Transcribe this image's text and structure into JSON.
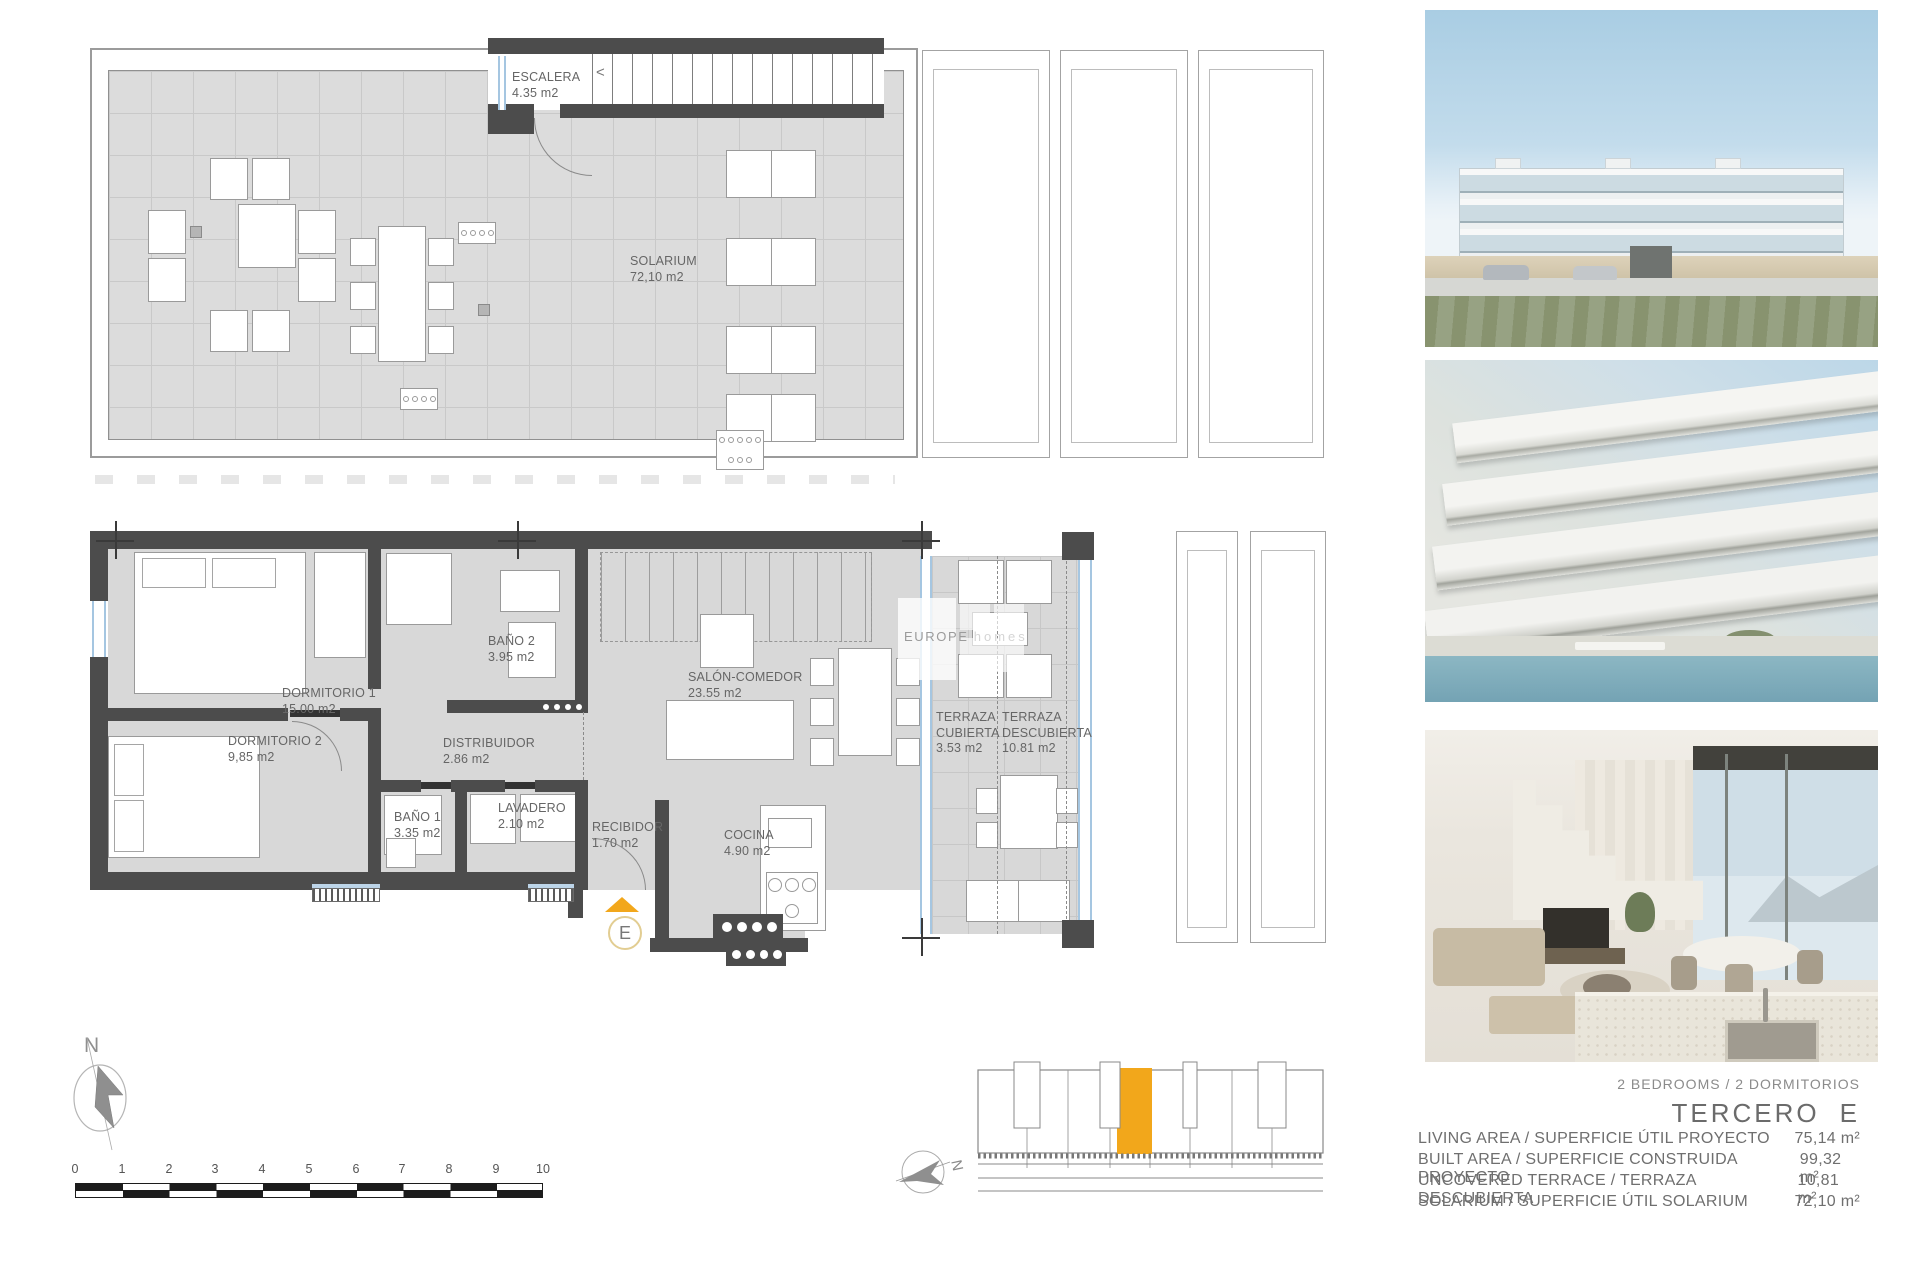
{
  "solarium_plan": {
    "rooms": [
      {
        "name": "ESCALERA",
        "area": "4.35 m2"
      },
      {
        "name": "SOLARIUM",
        "area": "72,10 m2"
      }
    ],
    "stairs_arrow": "<"
  },
  "floor_plan": {
    "rooms": [
      {
        "name": "DORMITORIO 1",
        "area": "15.00 m2"
      },
      {
        "name": "DORMITORIO 2",
        "area": "9,85 m2"
      },
      {
        "name": "BAÑO 2",
        "area": "3.95 m2"
      },
      {
        "name": "DISTRIBUIDOR",
        "area": "2.86 m2"
      },
      {
        "name": "BAÑO 1",
        "area": "3.35 m2"
      },
      {
        "name": "LAVADERO",
        "area": "2.10 m2"
      },
      {
        "name": "RECIBIDOR",
        "area": "1.70 m2"
      },
      {
        "name": "COCINA",
        "area": "4.90 m2"
      },
      {
        "name": "SALÓN-COMEDOR",
        "area": "23.55 m2"
      },
      {
        "name": "TERRAZA CUBIERTA",
        "area": "3.53 m2"
      },
      {
        "name": "TERRAZA DESCUBIERTA",
        "area": "10.81 m2"
      }
    ],
    "entrance_label": "E"
  },
  "watermark": {
    "brand": "EUROPE",
    "suffix": "homes"
  },
  "compass": {
    "north": "N"
  },
  "site_plan": {
    "north": "N"
  },
  "scale_bar": {
    "ticks": [
      "0",
      "1",
      "2",
      "3",
      "4",
      "5",
      "6",
      "7",
      "8",
      "9",
      "10"
    ]
  },
  "summary": {
    "bedrooms_line": "2 BEDROOMS / 2 DORMITORIOS",
    "floor_title": {
      "name": "TERCERO",
      "unit": "E"
    },
    "specs": [
      {
        "label": "LIVING AREA / SUPERFICIE ÚTIL PROYECTO",
        "value": "75,14 m²"
      },
      {
        "label": "BUILT AREA / SUPERFICIE CONSTRUIDA PROYECTO",
        "value": "99,32 m²"
      },
      {
        "label": "UNCOVERED TERRACE / TERRAZA DESCUBIERTA",
        "value": "10,81 m²"
      },
      {
        "label": "SOLARIUM / SUPERFICIE ÚTIL SOLARIUM",
        "value": "72,10 m²"
      }
    ]
  },
  "colors": {
    "accent_orange": "#F2A71B",
    "wall_dark": "#4c4c4c",
    "room_fill": "#d8d8d8",
    "glass_blue": "#a5c6e1"
  }
}
